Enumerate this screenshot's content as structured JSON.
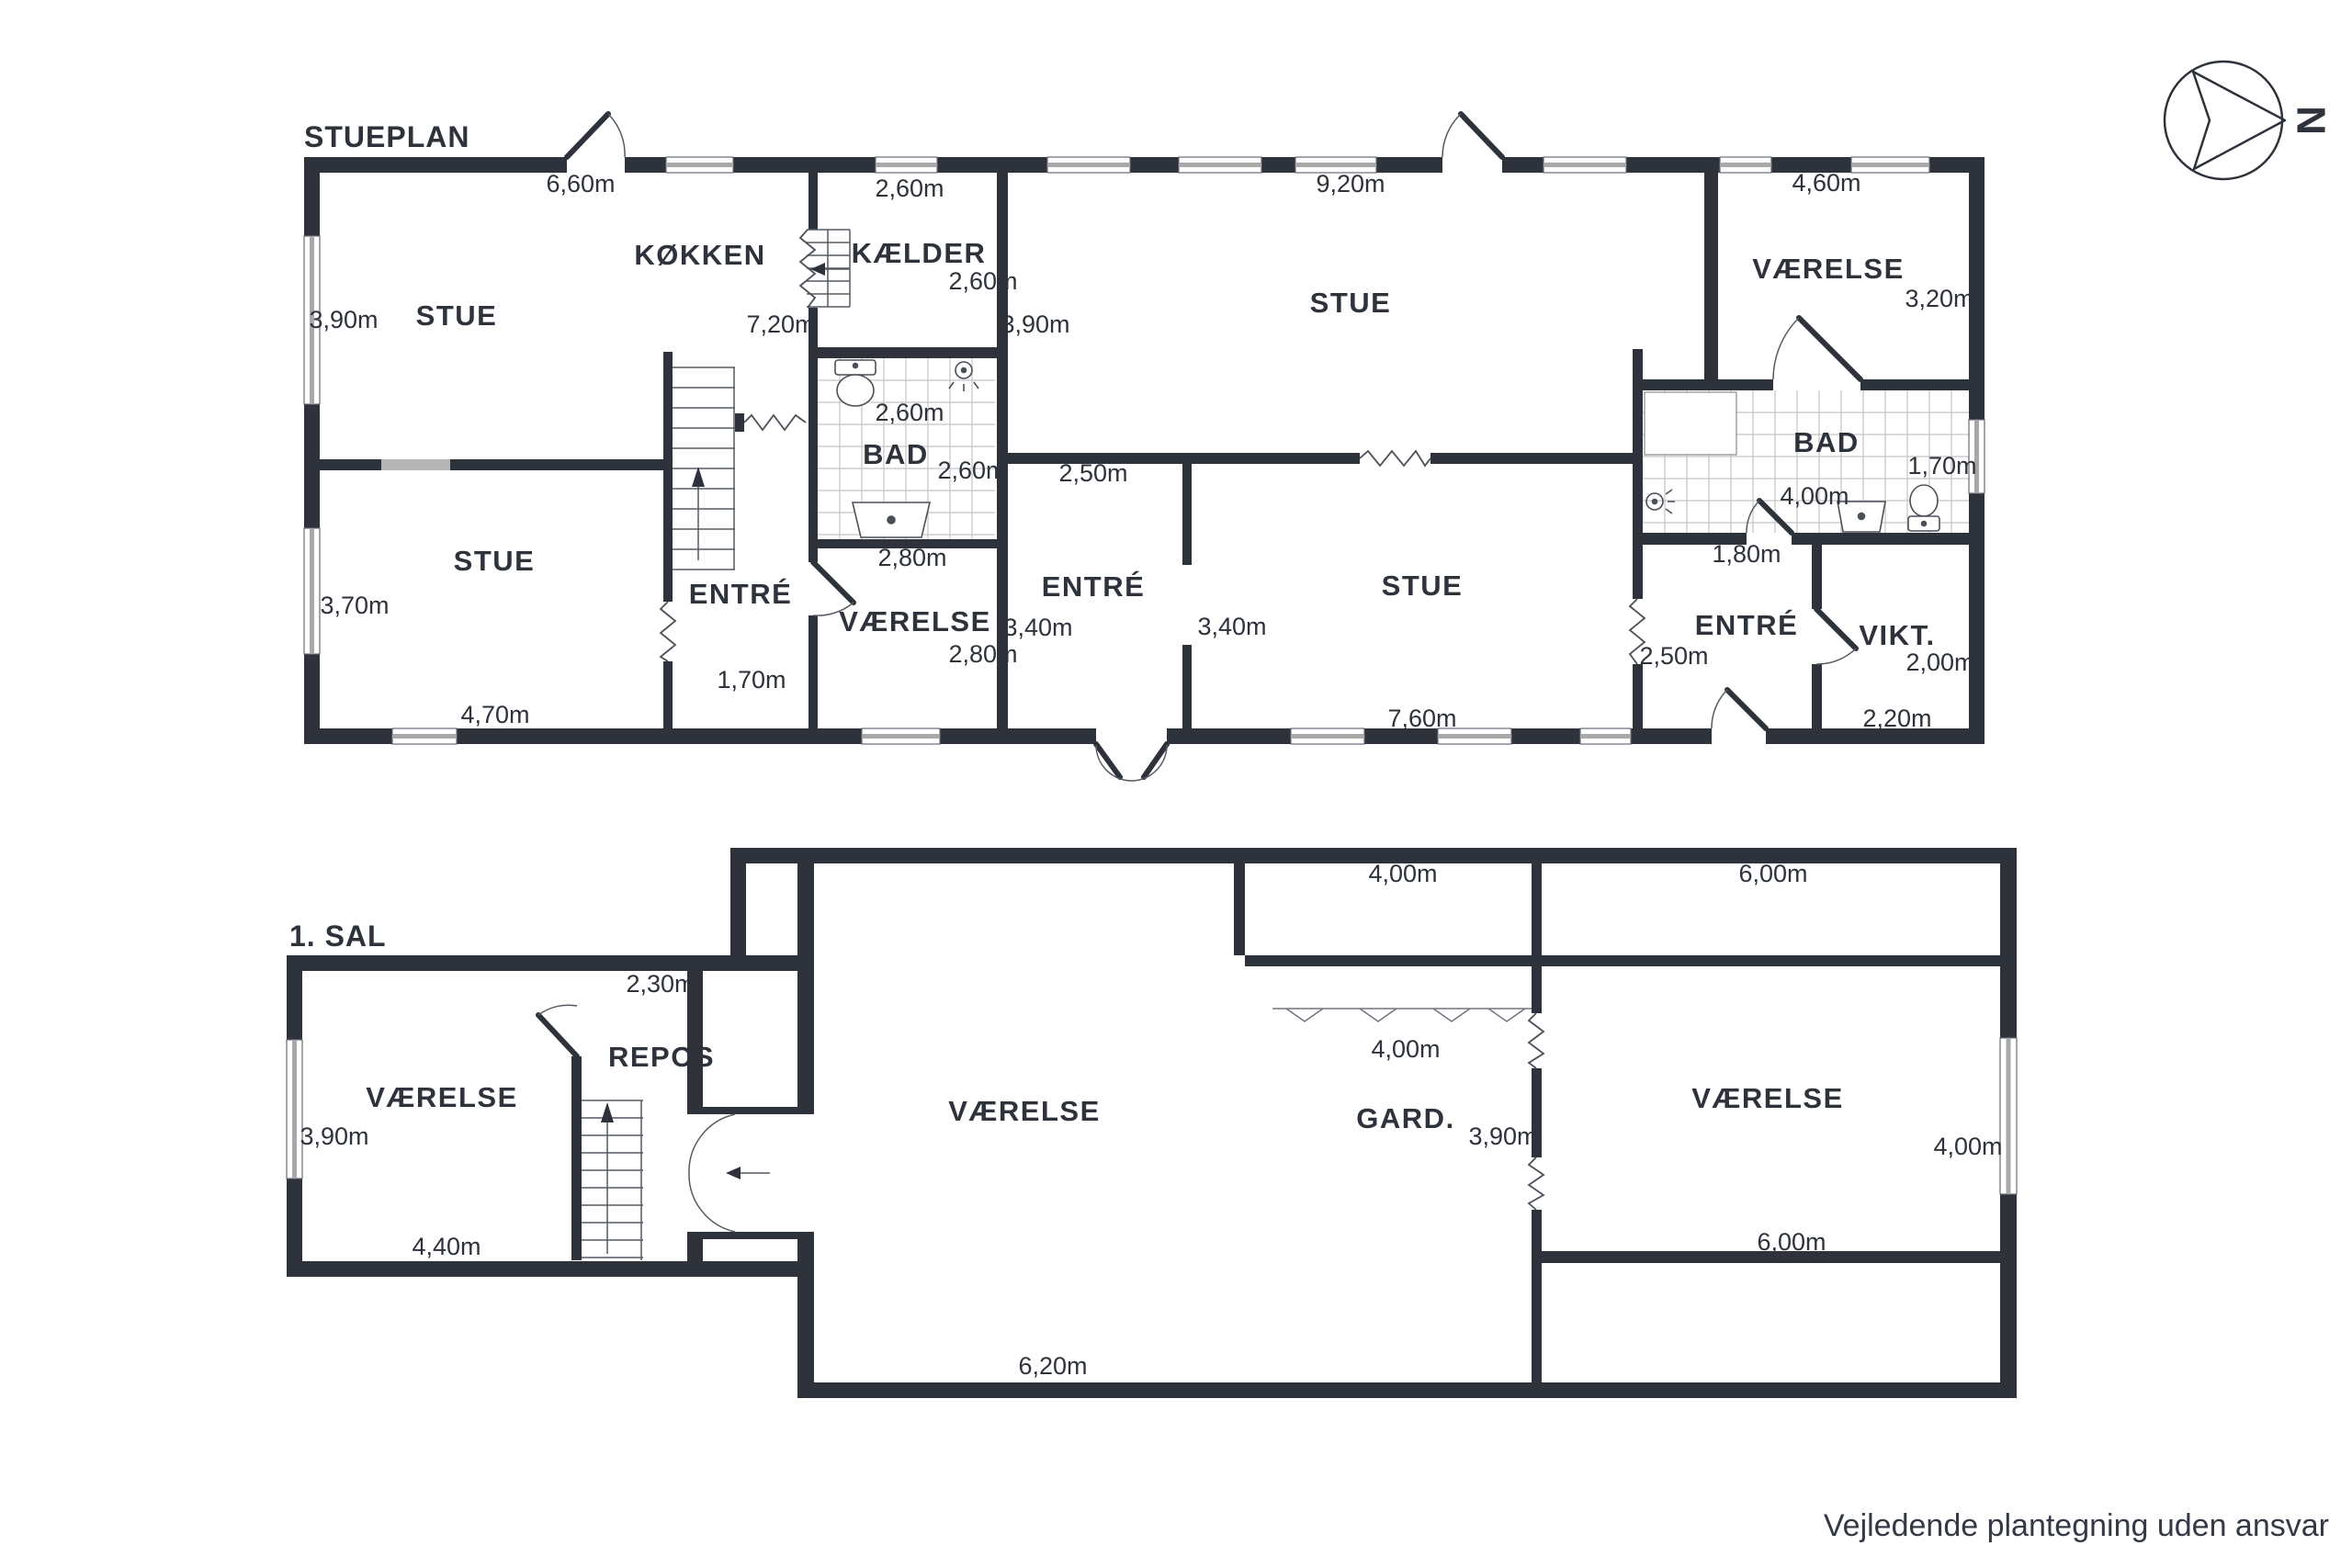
{
  "stueplan": {
    "title": "STUEPLAN",
    "rooms": [
      "STUE",
      "KØKKEN",
      "KÆLDER",
      "STUE",
      "ENTRÉ",
      "BAD",
      "VÆRELSE",
      "ENTRÉ",
      "STUE",
      "STUE",
      "VÆRELSE",
      "BAD",
      "ENTRÉ",
      "VIKT."
    ],
    "dims": [
      "6,60m",
      "2,60m",
      "9,20m",
      "4,60m",
      "3,90m",
      "7,20m",
      "2,60m",
      "3,90m",
      "3,20m",
      "2,60m",
      "2,60m",
      "2,50m",
      "1,70m",
      "4,00m",
      "2,80m",
      "1,80m",
      "3,70m",
      "2,80m",
      "3,40m",
      "3,40m",
      "2,50m",
      "2,00m",
      "1,70m",
      "4,70m",
      "7,60m",
      "2,20m"
    ]
  },
  "sal1": {
    "title": "1. SAL",
    "rooms": [
      "VÆRELSE",
      "REPOS",
      "VÆRELSE",
      "GARD.",
      "VÆRELSE"
    ],
    "dims": [
      "2,30m",
      "4,00m",
      "6,00m",
      "3,90m",
      "4,40m",
      "6,20m",
      "4,00m",
      "3,90m",
      "4,00m",
      "6,00m"
    ]
  },
  "compass": {
    "north": "N"
  },
  "footer": {
    "disclaimer": "Vejledende plantegning uden ansvar"
  }
}
